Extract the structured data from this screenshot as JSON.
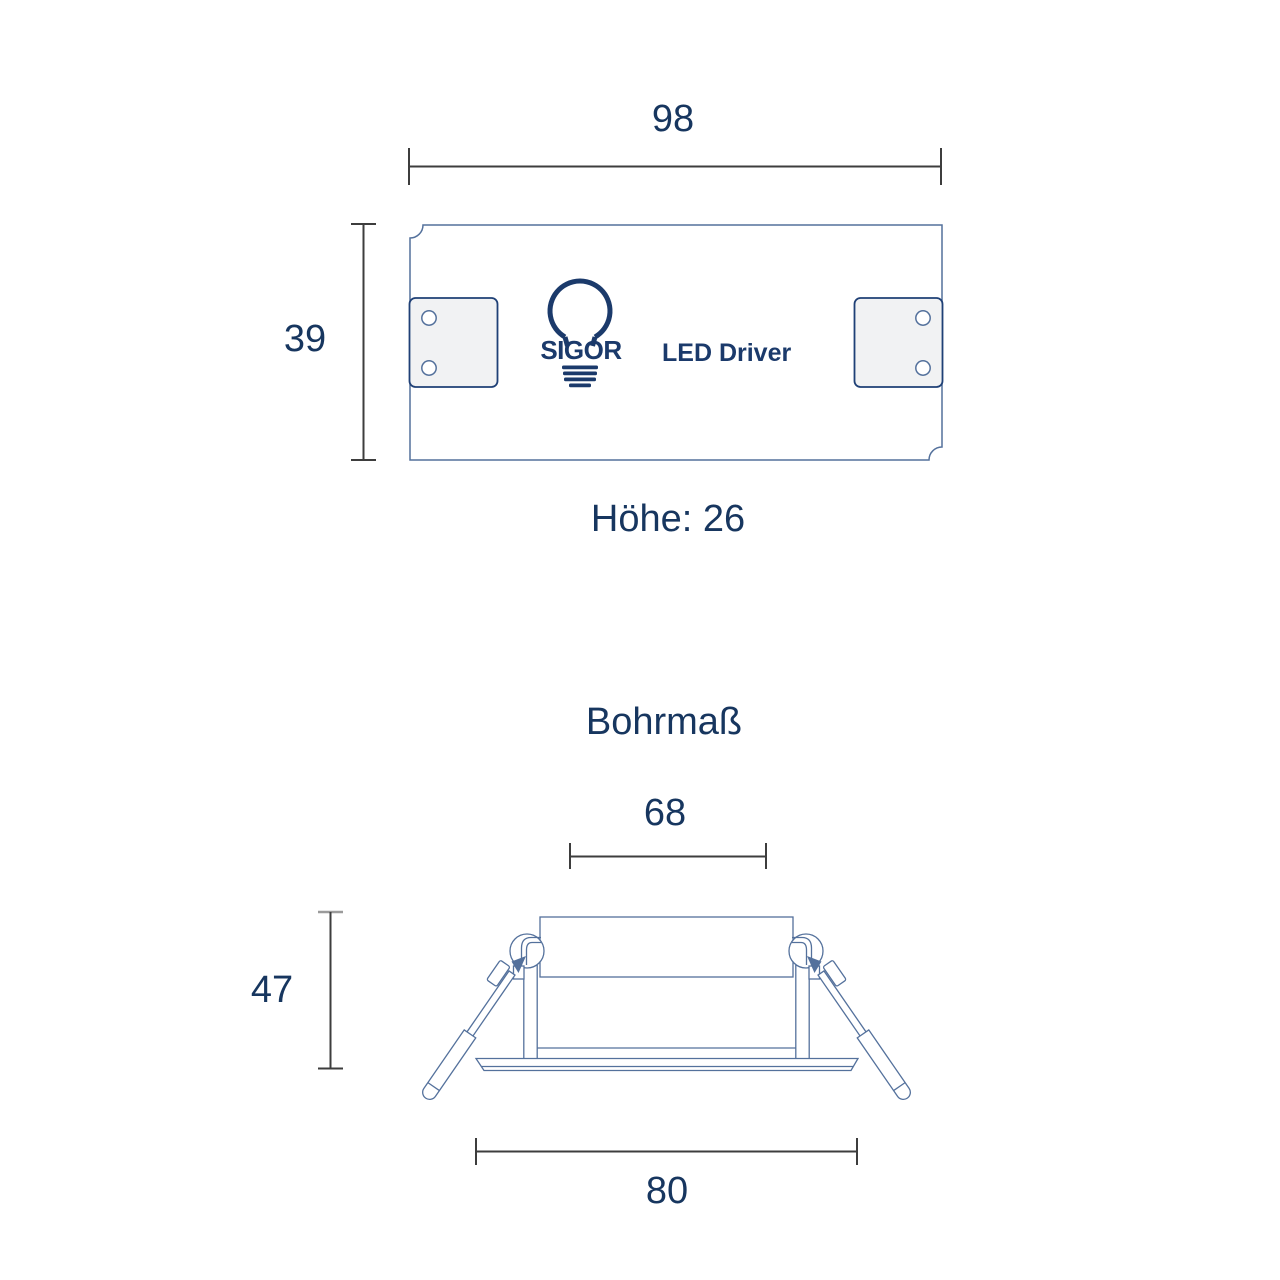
{
  "colors": {
    "label_navy": "#17365f",
    "logo_navy": "#1b3a6b",
    "drawing_slate": "#54719c",
    "dimension_gray": "#3d3d3d",
    "tab_fill": "#f1f2f3",
    "tab_border": "#1f4076",
    "background": "#ffffff"
  },
  "driver_diagram": {
    "width_dim": "98",
    "height_dim": "39",
    "height_note": "Höhe: 26",
    "brand": "SIGOR",
    "product_label": "LED Driver"
  },
  "drill_diagram": {
    "title": "Bohrmaß",
    "cutout_dim": "68",
    "depth_dim": "47",
    "outer_dim": "80"
  }
}
